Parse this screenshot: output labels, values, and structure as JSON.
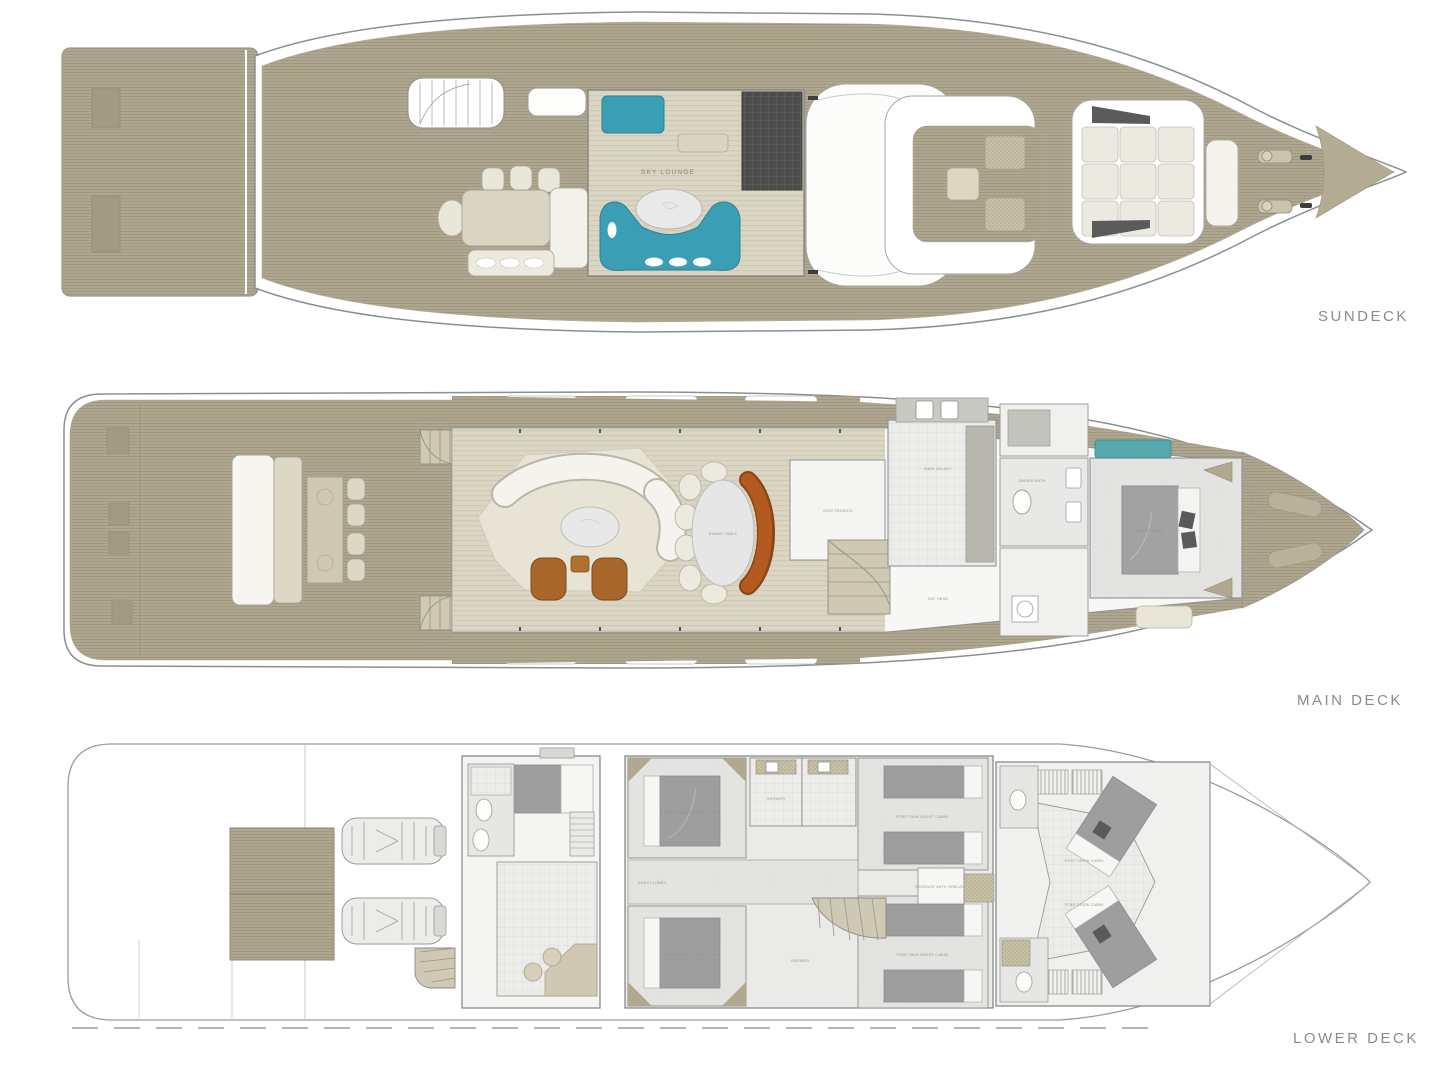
{
  "image_type": "yacht-deck-plan",
  "decks": [
    {
      "id": "sundeck",
      "label": "SUNDECK",
      "rooms": {
        "sky_lounge": "SKY LOUNGE"
      }
    },
    {
      "id": "main-deck",
      "label": "MAIN DECK",
      "rooms": {
        "dining_table": "DINING TABLE",
        "main_galley": "MAIN GALLEY",
        "electronics": "ELECTRONICS",
        "day_head": "DAY HEAD",
        "owner_bath": "OWNER BATH",
        "owner_cabin": "OWNER CABIN",
        "side_deck": "SIDE DECK"
      }
    },
    {
      "id": "lower-deck",
      "label": "LOWER DECK",
      "rooms": {
        "port_double_guest_cabin": "PORT DOUBLE GUEST CABIN",
        "stbd_double_guest_cabin": "STBD DOUBLE GUEST CABIN",
        "port_twin_guest_cabin": "PORT TWIN GUEST CABIN",
        "stbd_twin_guest_cabin": "STBD TWIN GUEST CABIN",
        "guest_lobby": "GUEST LOBBY",
        "storage": "STORAGE WITH SHELVES",
        "shower_port": "SHOWER",
        "shower_stbd": "SHOWER",
        "port_crew_cabin": "PORT CREW CABIN",
        "stbd_crew_cabin": "STBD CREW CABIN"
      }
    }
  ],
  "colors": {
    "teak_deck": "#aea68f",
    "interior_floor": "#dbd5c3",
    "accent_teal": "#3a9fb4",
    "banquette_orange": "#b35a20",
    "armchair_brown": "#a9662a",
    "bed_gray": "#9e9e9e",
    "hull_outline": "#8a9090",
    "label_gray": "#8b8b8b"
  }
}
